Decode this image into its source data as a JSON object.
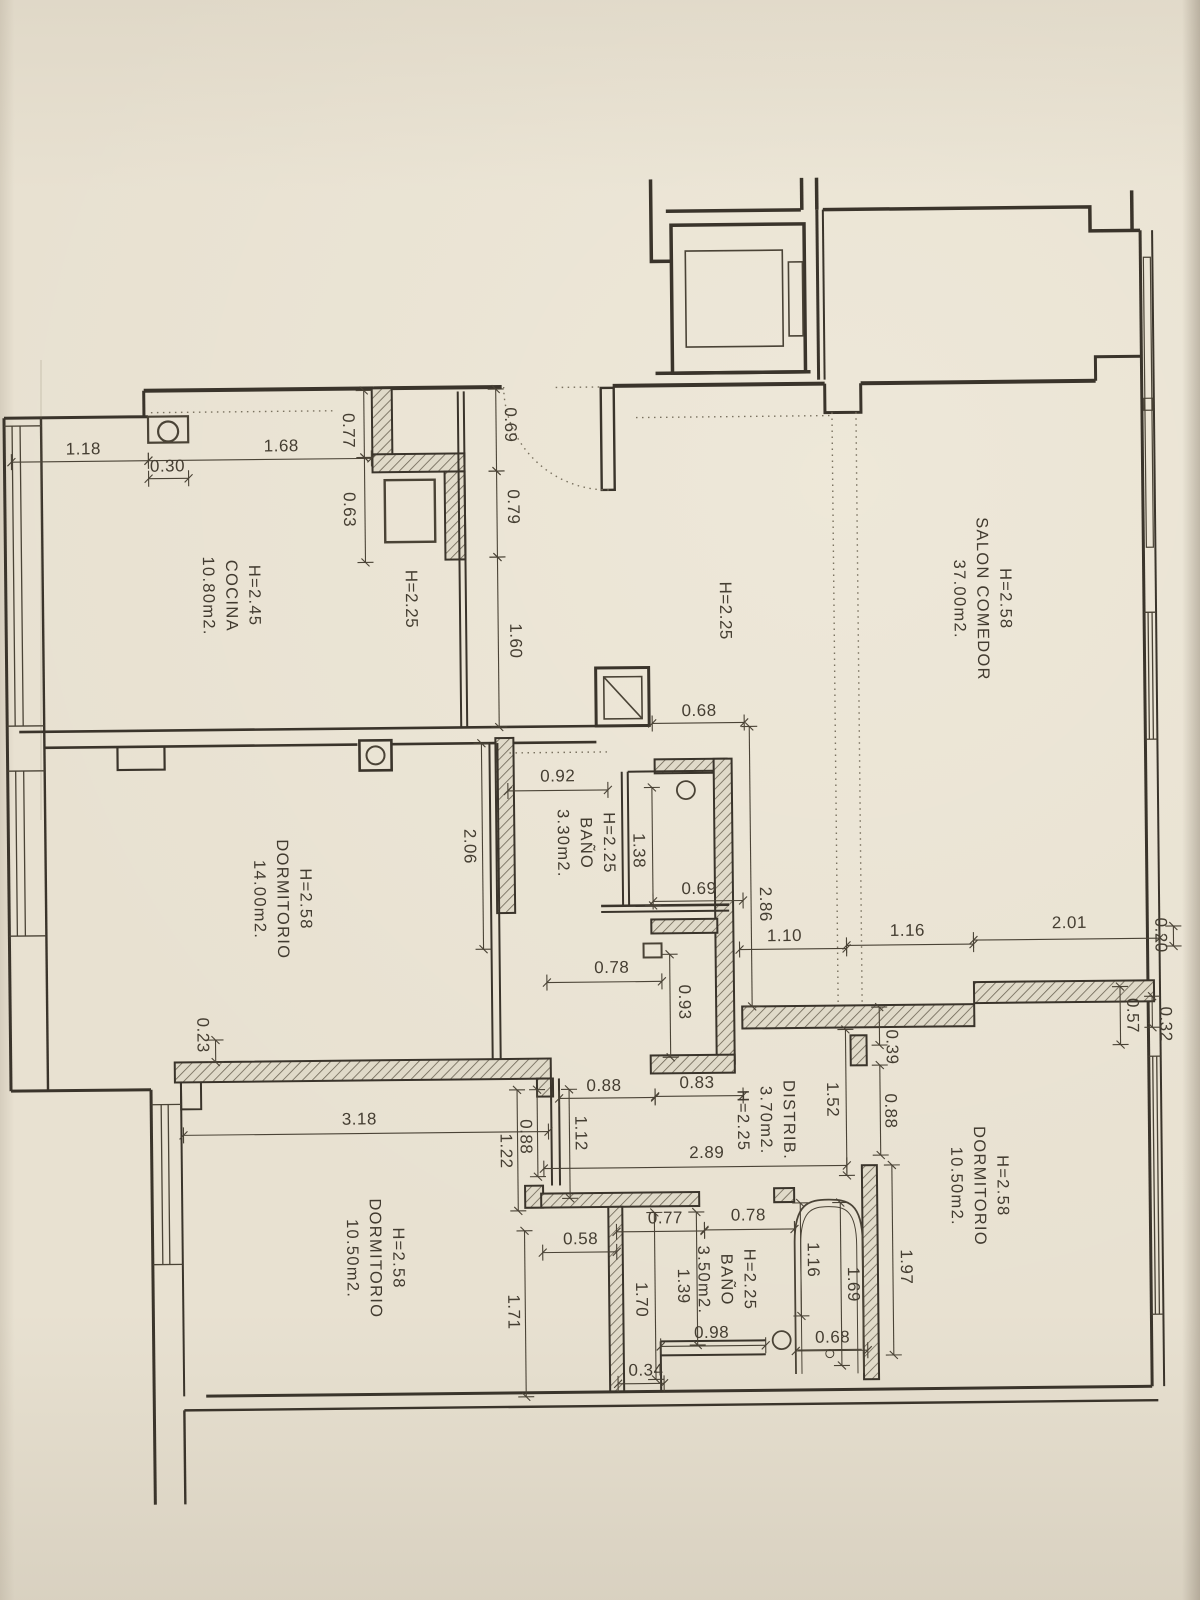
{
  "document": {
    "kind": "scanned apartment floor plan",
    "paper_color": "#e8e1d1",
    "ink_color": "#3a342b",
    "text_rotation_deg": 90
  },
  "rooms": [
    {
      "id": "cocina",
      "lines": [
        "H=2.45",
        "COCINA",
        "10.80m2."
      ],
      "x": 233,
      "y": 592
    },
    {
      "id": "salon-comedor",
      "lines": [
        "H=2.58",
        "SALON  COMEDOR",
        "37.00m2."
      ],
      "x": 984,
      "y": 603
    },
    {
      "id": "dormitorio-1",
      "lines": [
        "H=2.58",
        "DORMITORIO",
        "14.00m2."
      ],
      "x": 281,
      "y": 896
    },
    {
      "id": "bano-1",
      "lines": [
        "H=2.25",
        "BAÑO",
        "3.30m2."
      ],
      "x": 585,
      "y": 843
    },
    {
      "id": "distribuidor",
      "lines": [
        "DISTRIB.",
        "3.70m2.",
        "H=2.25"
      ],
      "x": 762,
      "y": 1122
    },
    {
      "id": "dormitorio-2",
      "lines": [
        "H=2.58",
        "DORMITORIO",
        "10.50m2."
      ],
      "x": 975,
      "y": 1190
    },
    {
      "id": "bano-2",
      "lines": [
        "H=2.25",
        "BAÑO",
        "3.50m2."
      ],
      "x": 721,
      "y": 1281
    },
    {
      "id": "dormitorio-3",
      "lines": [
        "H=2.58",
        "DORMITORIO",
        "10.50m2."
      ],
      "x": 370,
      "y": 1256
    }
  ],
  "height_labels": [
    {
      "text": "H=2.25",
      "x": 413,
      "y": 597
    },
    {
      "text": "H=2.25",
      "x": 727,
      "y": 612
    }
  ],
  "dimensions": [
    {
      "v": "1.18",
      "x": 87,
      "y": 444,
      "rot": 0,
      "line": [
        15,
        456,
        152,
        456
      ]
    },
    {
      "v": "0.30",
      "x": 171,
      "y": 462,
      "rot": 0,
      "line": [
        152,
        474,
        192,
        474
      ]
    },
    {
      "v": "1.68",
      "x": 285,
      "y": 443,
      "rot": 0,
      "line": [
        152,
        456,
        375,
        456
      ]
    },
    {
      "v": "0.77",
      "x": 352,
      "y": 428,
      "rot": 90,
      "line": [
        368,
        388,
        368,
        455
      ]
    },
    {
      "v": "0.63",
      "x": 352,
      "y": 507,
      "rot": 90,
      "line": [
        368,
        455,
        368,
        560
      ]
    },
    {
      "v": "0.69",
      "x": 514,
      "y": 424,
      "rot": 90,
      "line": [
        500,
        388,
        500,
        470
      ]
    },
    {
      "v": "0.79",
      "x": 516,
      "y": 506,
      "rot": 90,
      "line": [
        500,
        470,
        500,
        556
      ]
    },
    {
      "v": "1.60",
      "x": 517,
      "y": 640,
      "rot": 90,
      "line": [
        500,
        556,
        500,
        726
      ]
    },
    {
      "v": "0.68",
      "x": 700,
      "y": 712,
      "rot": 0,
      "line": [
        653,
        724,
        745,
        724
      ]
    },
    {
      "v": "0.92",
      "x": 558,
      "y": 776,
      "rot": 0,
      "line": [
        508,
        790,
        608,
        790
      ]
    },
    {
      "v": "1.38",
      "x": 638,
      "y": 851,
      "rot": 90,
      "line": [
        652,
        788,
        652,
        906
      ]
    },
    {
      "v": "0.69",
      "x": 698,
      "y": 890,
      "rot": 0,
      "line": [
        652,
        902,
        742,
        902
      ]
    },
    {
      "v": "2.06",
      "x": 469,
      "y": 845,
      "rot": 90,
      "line": [
        482,
        742,
        482,
        948
      ]
    },
    {
      "v": "0.78",
      "x": 610,
      "y": 968,
      "rot": 0,
      "line": [
        545,
        982,
        660,
        982
      ]
    },
    {
      "v": "0.93",
      "x": 682,
      "y": 1003,
      "rot": 90,
      "line": [
        668,
        955,
        668,
        1058
      ]
    },
    {
      "v": "2.86",
      "x": 764,
      "y": 906,
      "rot": 90,
      "line": [
        750,
        728,
        750,
        1008
      ]
    },
    {
      "v": "1.10",
      "x": 783,
      "y": 938,
      "rot": 0,
      "line": [
        738,
        951,
        845,
        951
      ]
    },
    {
      "v": "1.16",
      "x": 906,
      "y": 934,
      "rot": 0,
      "line": [
        845,
        948,
        972,
        948
      ]
    },
    {
      "v": "2.01",
      "x": 1068,
      "y": 928,
      "rot": 0,
      "line": [
        972,
        944,
        1158,
        944
      ]
    },
    {
      "v": "0.20",
      "x": 1159,
      "y": 941,
      "rot": 90,
      "line": [
        1172,
        932,
        1172,
        952
      ]
    },
    {
      "v": "0.57",
      "x": 1130,
      "y": 1021,
      "rot": 90,
      "line": [
        1118,
        992,
        1118,
        1050
      ]
    },
    {
      "v": "0.32",
      "x": 1163,
      "y": 1030,
      "rot": 90,
      "line": [
        1150,
        1002,
        1150,
        1033
      ]
    },
    {
      "v": "0.39",
      "x": 889,
      "y": 1050,
      "rot": 90,
      "line": [
        877,
        1010,
        877,
        1048
      ]
    },
    {
      "v": "0.88",
      "x": 887,
      "y": 1114,
      "rot": 90,
      "line": [
        877,
        1068,
        877,
        1158
      ]
    },
    {
      "v": "1.52",
      "x": 829,
      "y": 1102,
      "rot": 90,
      "line": [
        843,
        1032,
        843,
        1178
      ]
    },
    {
      "v": "0.23",
      "x": 200,
      "y": 1031,
      "rot": 90,
      "line": [
        213,
        1036,
        213,
        1058
      ]
    },
    {
      "v": "3.18",
      "x": 356,
      "y": 1117,
      "rot": 0,
      "line": [
        180,
        1131,
        545,
        1131
      ]
    },
    {
      "v": "0.88",
      "x": 601,
      "y": 1086,
      "rot": 0,
      "line": [
        556,
        1098,
        652,
        1098
      ]
    },
    {
      "v": "0.83",
      "x": 694,
      "y": 1084,
      "rot": 0,
      "line": [
        652,
        1097,
        740,
        1097
      ]
    },
    {
      "v": "0.88",
      "x": 522,
      "y": 1136,
      "rot": 90,
      "line": [
        534,
        1089,
        534,
        1176
      ]
    },
    {
      "v": "1.22",
      "x": 502,
      "y": 1150,
      "rot": 90,
      "line": [
        514,
        1089,
        514,
        1210
      ]
    },
    {
      "v": "1.12",
      "x": 577,
      "y": 1133,
      "rot": 90,
      "line": [
        566,
        1089,
        566,
        1198
      ]
    },
    {
      "v": "2.89",
      "x": 703,
      "y": 1154,
      "rot": 0,
      "line": [
        540,
        1168,
        843,
        1168
      ]
    },
    {
      "v": "0.58",
      "x": 576,
      "y": 1239,
      "rot": 0,
      "line": [
        538,
        1252,
        612,
        1252
      ]
    },
    {
      "v": "0.77",
      "x": 661,
      "y": 1219,
      "rot": 0,
      "line": [
        612,
        1232,
        700,
        1232
      ]
    },
    {
      "v": "0.78",
      "x": 744,
      "y": 1217,
      "rot": 0,
      "line": [
        700,
        1231,
        790,
        1231
      ]
    },
    {
      "v": "1.71",
      "x": 508,
      "y": 1311,
      "rot": 90,
      "line": [
        520,
        1230,
        520,
        1396
      ]
    },
    {
      "v": "1.70",
      "x": 636,
      "y": 1300,
      "rot": 90,
      "line": [
        650,
        1213,
        650,
        1380
      ]
    },
    {
      "v": "1.39",
      "x": 678,
      "y": 1287,
      "rot": 90,
      "line": [
        692,
        1213,
        692,
        1346
      ]
    },
    {
      "v": "1.16",
      "x": 808,
      "y": 1262,
      "rot": 90,
      "line": [
        796,
        1205,
        796,
        1318
      ]
    },
    {
      "v": "1.69",
      "x": 848,
      "y": 1287,
      "rot": 90,
      "line": [
        836,
        1205,
        836,
        1368
      ]
    },
    {
      "v": "1.97",
      "x": 901,
      "y": 1270,
      "rot": 90,
      "line": [
        888,
        1168,
        888,
        1358
      ]
    },
    {
      "v": "0.98",
      "x": 706,
      "y": 1334,
      "rot": 0,
      "line": [
        655,
        1347,
        760,
        1347
      ]
    },
    {
      "v": "0.68",
      "x": 827,
      "y": 1340,
      "rot": 0,
      "line": [
        790,
        1353,
        862,
        1353
      ]
    },
    {
      "v": "0.34",
      "x": 640,
      "y": 1371,
      "rot": 0,
      "line": [
        612,
        1384,
        658,
        1384
      ]
    }
  ]
}
